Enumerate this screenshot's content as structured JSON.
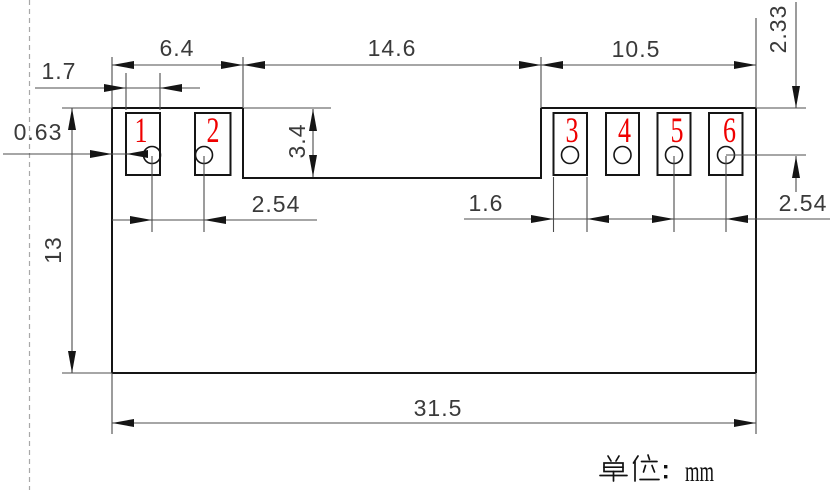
{
  "dims": {
    "left_span": "6.4",
    "center_span": "14.6",
    "right_span": "10.5",
    "left_pad_width": "1.7",
    "left_edge_gap": "0.63",
    "notch_depth": "3.4",
    "hole_row_offset": "2.33",
    "left_hole_pitch": "2.54",
    "right_pad_width": "1.6",
    "right_hole_pitch": "2.54",
    "body_height": "13",
    "body_width": "31.5"
  },
  "pads": [
    {
      "number": "1"
    },
    {
      "number": "2"
    },
    {
      "number": "3"
    },
    {
      "number": "4"
    },
    {
      "number": "5"
    },
    {
      "number": "6"
    }
  ],
  "footer": {
    "unit_label": "单位：mm",
    "unit_text": "mm"
  },
  "colors": {
    "outline": "#151515",
    "dimension_line": "#4c4c4c",
    "pin_number": "#ef0000",
    "dashed_centerline": "#a8a8a8"
  }
}
